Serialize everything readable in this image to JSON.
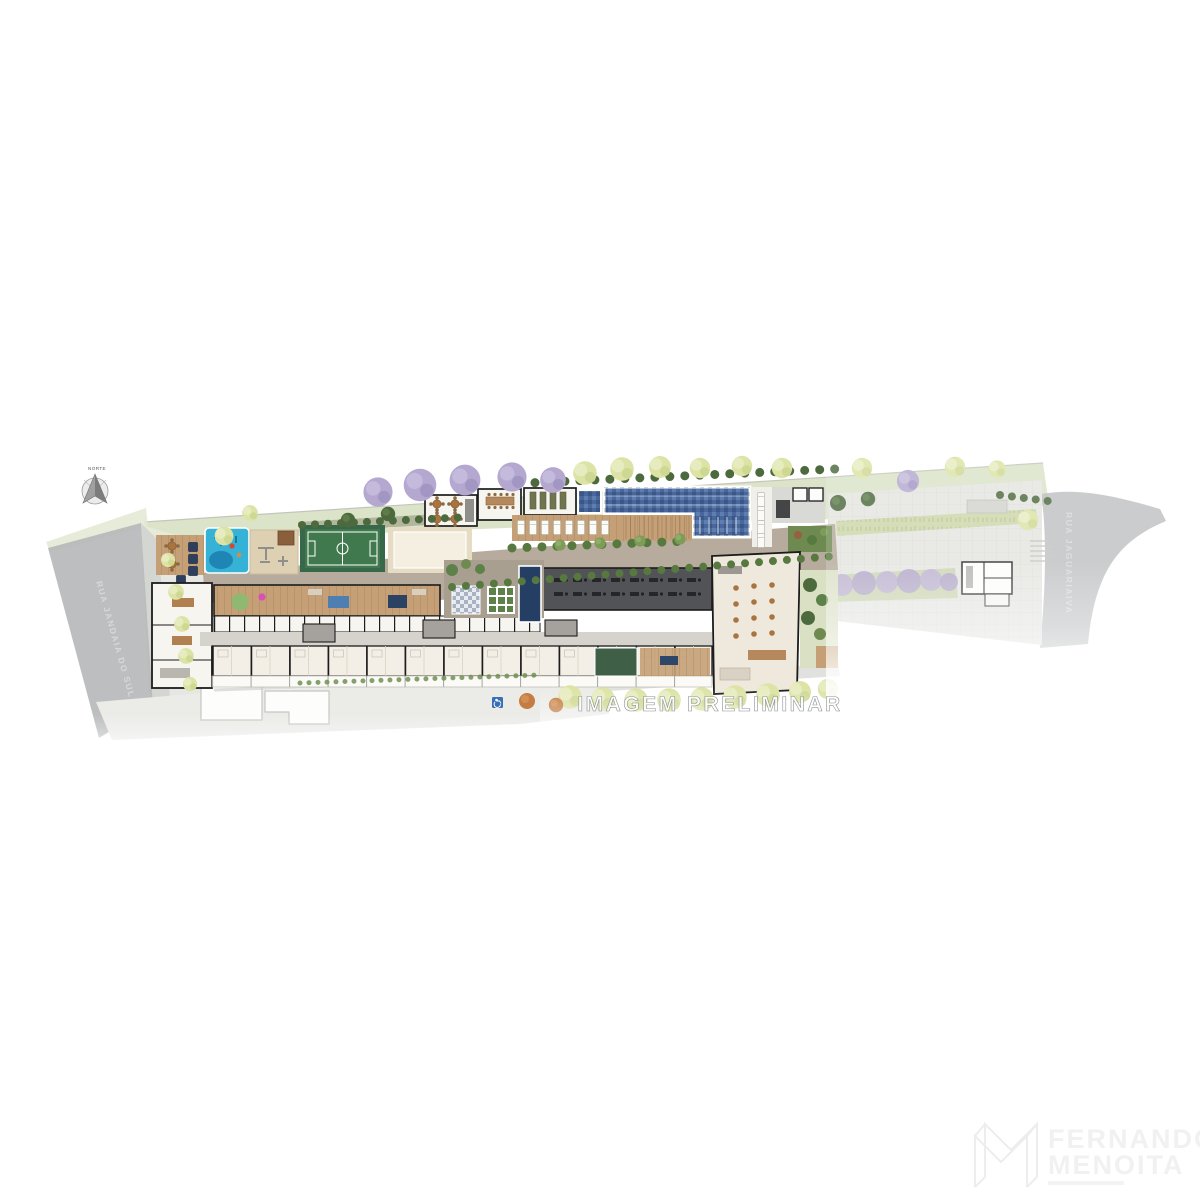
{
  "compass": {
    "label": "NORTE"
  },
  "streets": {
    "left": "RUA JANDAIA DO SUL",
    "right": "RUA JAGUARIAIVA"
  },
  "watermark": {
    "text": "IMAGEM PRELIMINAR"
  },
  "logo": {
    "line1": "FERNANDO",
    "line2": "MENOITA"
  },
  "icons": {
    "compass": "north-arrow-icon",
    "accessibility": "wheelchair-icon"
  },
  "colors": {
    "lawn": "#dbe3c8",
    "lawn_light": "#e6ebd8",
    "street": "#b6b8ba",
    "sidewalk": "#cfd2d0",
    "plaza": "#e4e4e1",
    "pool": "#47689f",
    "kids_pool": "#35b2d6",
    "court": "#41794f",
    "sand": "#f4efe0",
    "deck_wood": "#c5a076",
    "gym": "#515356",
    "building_floor": "#f7f5f0",
    "wall": "#1c1c1c",
    "corridor": "#d6d3cd",
    "garage": "#ebebe8",
    "spa": "#243f63",
    "tree_dark": "#4d6a3e",
    "tree_pale": "#dce3a4",
    "tree_purple": "#b4a8d0",
    "tree_orange": "#c57c42",
    "shrub_purple": "#b7a9d3",
    "accessibility_blue": "#3a6fb5"
  }
}
